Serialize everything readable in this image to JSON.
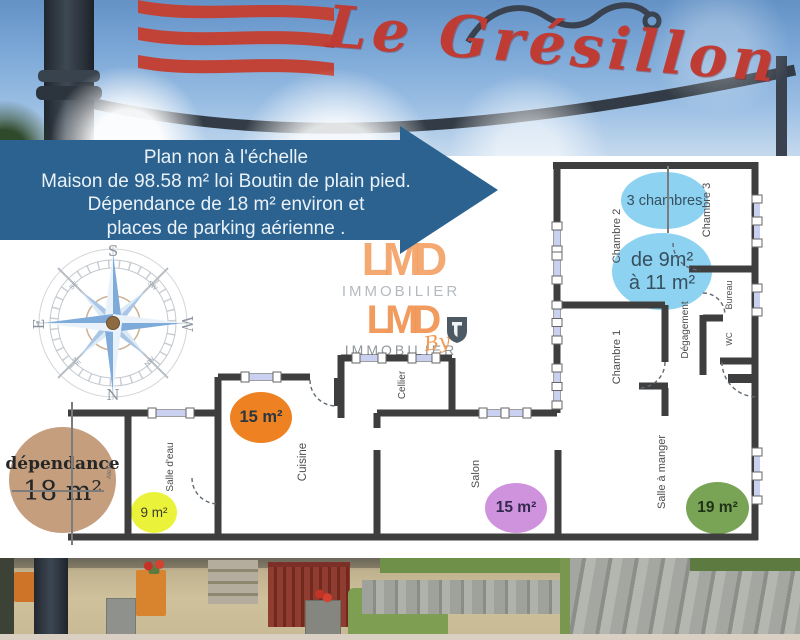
{
  "photo_header": {
    "sign_text": "Le Grésillon"
  },
  "banner": {
    "lines": [
      "Plan non à l'échelle",
      "Maison de 98.58 m² loi Boutin de plain pied.",
      "Dépendance de 18 m² environ et",
      "places de parking aérienne ."
    ]
  },
  "compass": {
    "south": "S",
    "north": "N",
    "east": "E",
    "west": "W",
    "se": "SE",
    "sw": "SW",
    "ne": "NE",
    "nw": "NW"
  },
  "watermark": {
    "brand_line1": "LMD",
    "subtitle_line1": "IMMOBILIER",
    "brand_line2": "LMD",
    "subtitle_line2": "IMMOBILIER",
    "by": "By"
  },
  "floor_plan": {
    "rooms": {
      "chambre_1": "Chambre 1",
      "chambre_2": "Chambre 2",
      "chambre_3": "Chambre 3",
      "bureau": "Bureau",
      "wc": "WC",
      "degagement": "Dégagement",
      "cellier": "Cellier",
      "cuisine": "Cuisine",
      "salle_deau": "Salle d'eau",
      "salon": "Salon",
      "salle_a_manger": "Salle à manger",
      "atelier": "Atelier"
    },
    "bubbles": {
      "bedrooms_count": "3 chambres",
      "bedrooms_size_line1": "de 9m²",
      "bedrooms_size_line2": "à 11 m²",
      "cuisine_size": "15 m²",
      "salle_deau_size": "9 m²",
      "salon_size": "15 m²",
      "salle_a_manger_size": "19 m²",
      "dependance_label": "dépendance",
      "dependance_size": "18 m²"
    }
  },
  "colors": {
    "banner_blue": "#2b6290",
    "bubble_blue": "#8dd2f1",
    "bubble_orange": "#ee8222",
    "bubble_yellow": "#ebf23a",
    "bubble_purple": "#cf92dd",
    "bubble_green": "#79a355",
    "bubble_tan": "#c29b79",
    "wall": "#3e3e3e",
    "sign_red": "#bf3c35",
    "watermark_orange": "#f29d5f"
  }
}
